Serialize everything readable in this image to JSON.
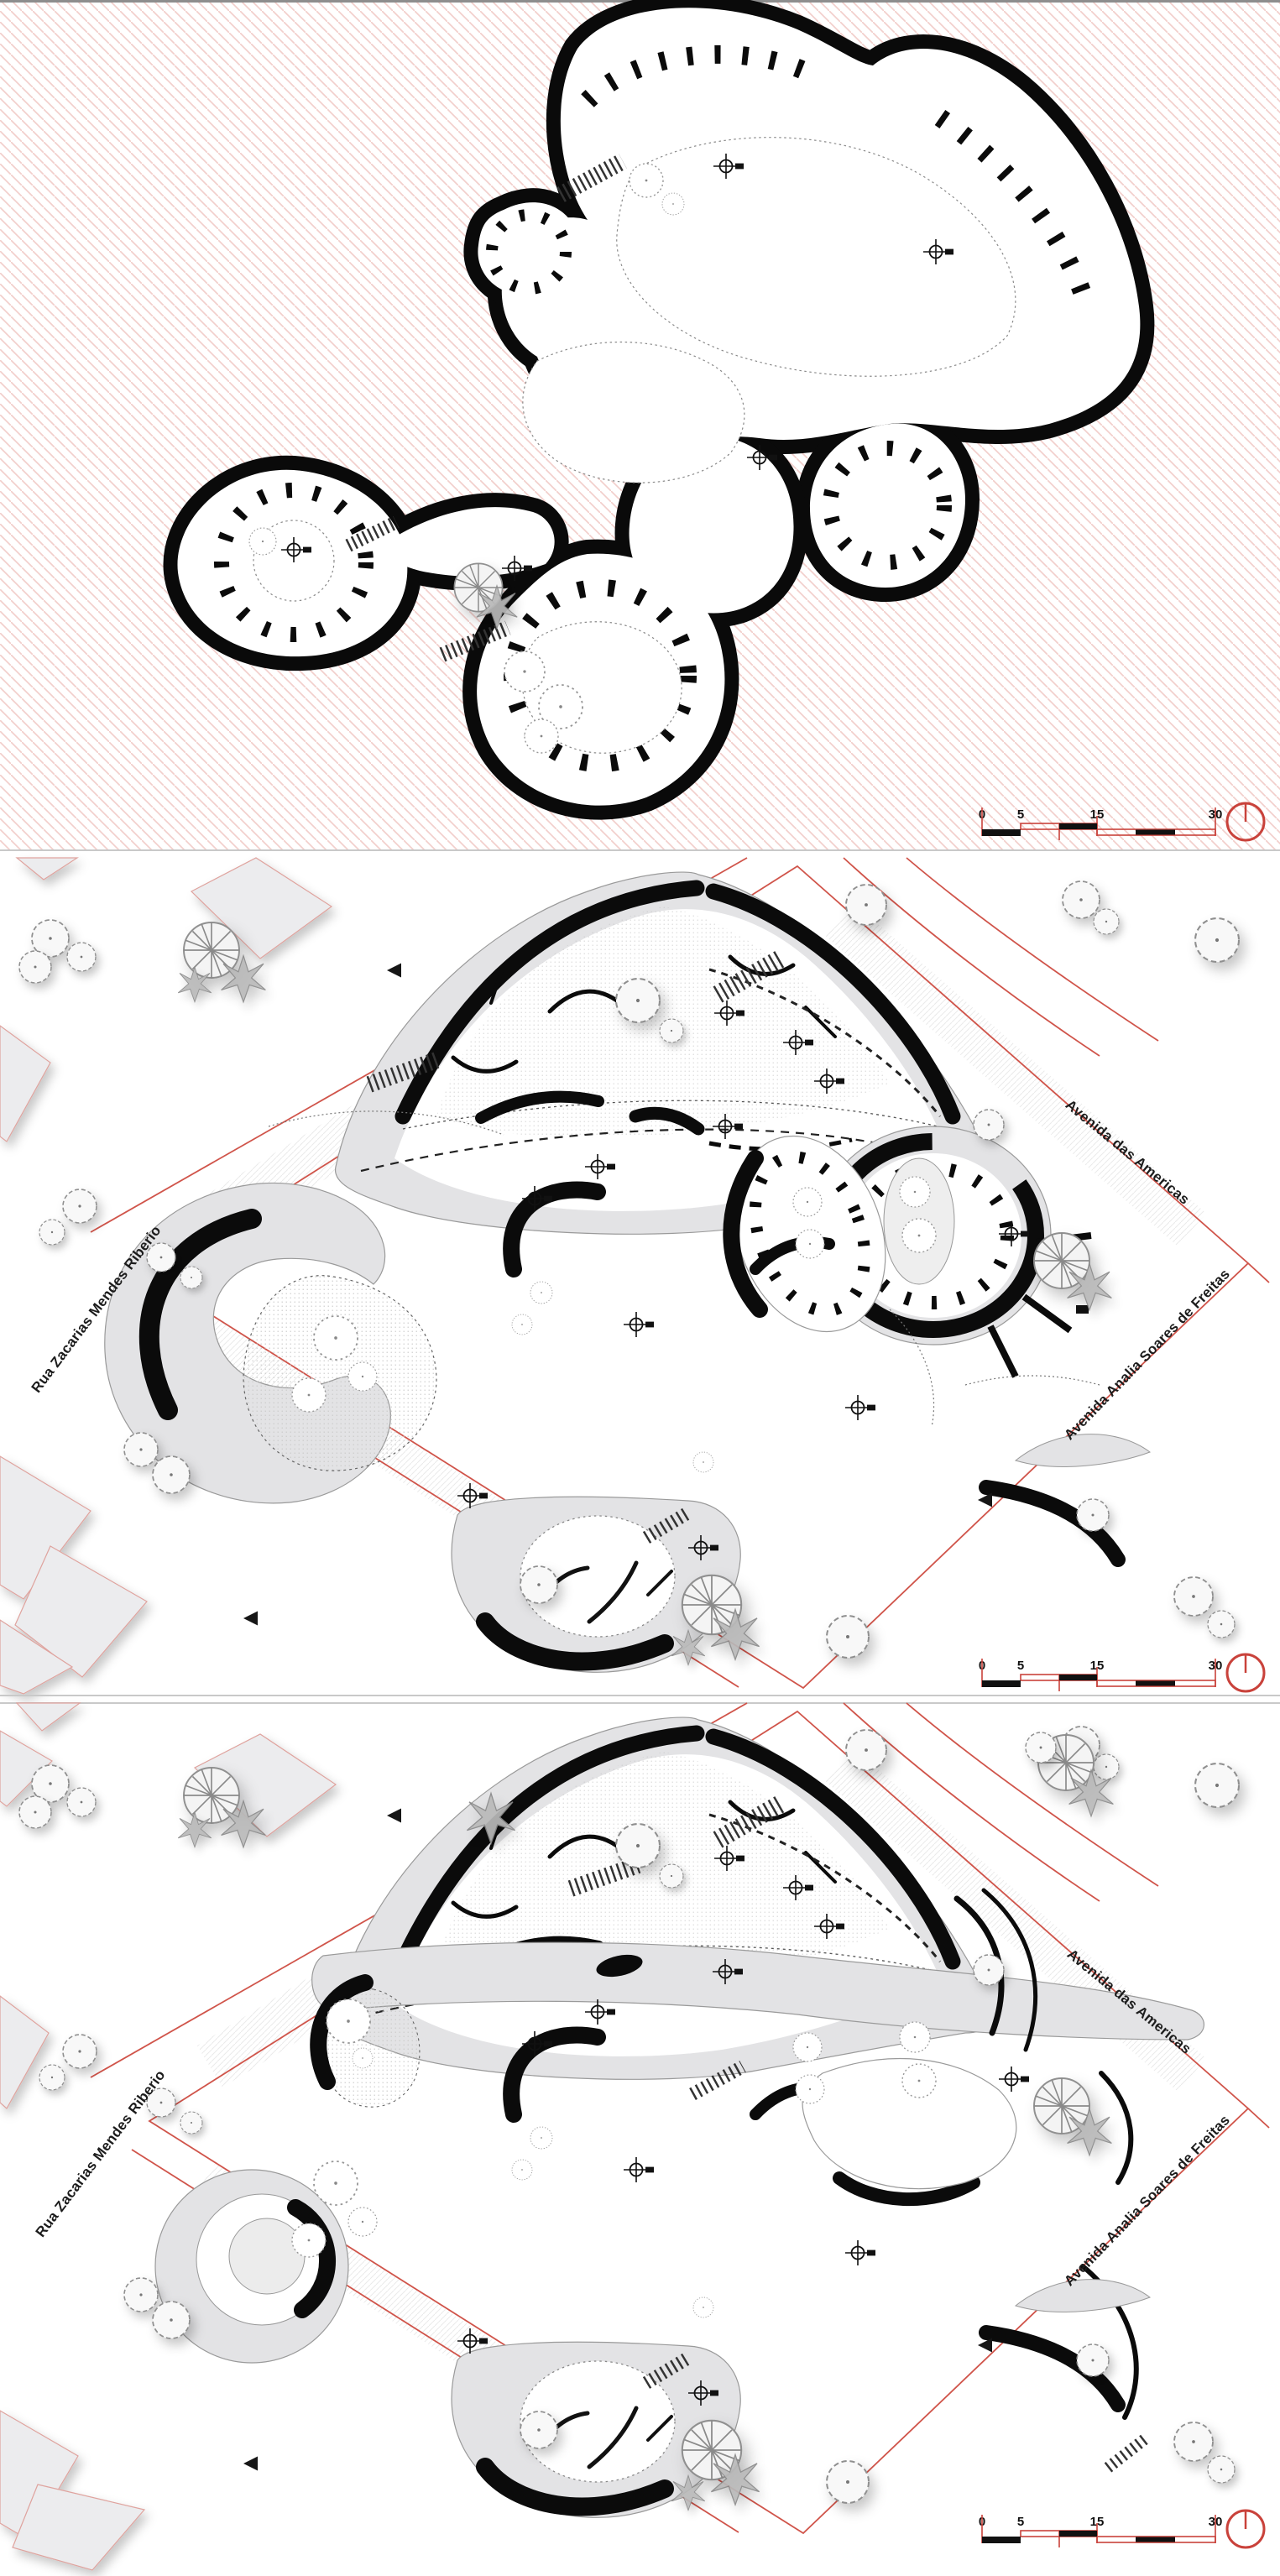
{
  "streets": {
    "west": "Rua Zacarias Mendes Riberio",
    "northeast": "Avenida das Americas",
    "southeast": "Avenida Analia Soares de Freitas"
  },
  "scale_bar": {
    "ticks": [
      "0",
      "5",
      "15",
      "30"
    ]
  },
  "icons": {
    "north_arrow": "north-arrow-icon",
    "entry_marker": "triangle-marker",
    "survey_point": "crosshair-marker"
  },
  "colors": {
    "boundary_red": "#d0544a",
    "scale_red": "#c9423b",
    "hatch_pink": "#f2cfcc",
    "surface_gray": "#e3e3e5",
    "line_gray": "#9a9a9a",
    "ink": "#0b0b0b",
    "context_fill": "#ececee",
    "context_outline": "#dfa39e"
  }
}
